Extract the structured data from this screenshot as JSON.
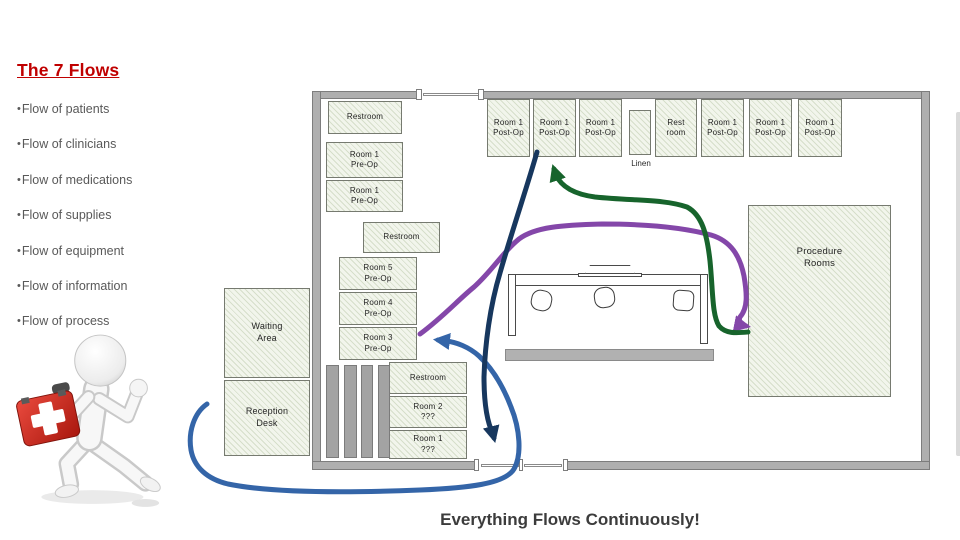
{
  "slide": {
    "title": "The 7 Flows",
    "bullet_char": "•",
    "bullets": [
      "Flow of patients",
      "Flow of clinicians",
      "Flow of medications",
      "Flow of supplies",
      "Flow of equipment",
      "Flow of information",
      "Flow of process"
    ],
    "caption": "Everything Flows Continuously!"
  },
  "colors": {
    "title_red": "#C00000",
    "bullet_text": "#595959",
    "caption_text": "#3c3c3c",
    "wall_gray": "#afafaf",
    "room_fill": "#f2f5ec",
    "flow_blue": "#3465A8",
    "flow_purple": "#8447A9",
    "flow_green": "#17642C",
    "flow_navy": "#17375E",
    "kit_red": "#C62B1F"
  },
  "floor_plan": {
    "linen_label": "Linen",
    "rooms": [
      {
        "id": "restroom-top-left",
        "label": "Restroom",
        "x": 328,
        "y": 101,
        "w": 74,
        "h": 33
      },
      {
        "id": "room1-preop-a",
        "label": "Room 1\nPre-Op",
        "x": 326,
        "y": 142,
        "w": 77,
        "h": 36
      },
      {
        "id": "room1-preop-b",
        "label": "Room 1\nPre-Op",
        "x": 326,
        "y": 180,
        "w": 77,
        "h": 32
      },
      {
        "id": "restroom-mid",
        "label": "Restroom",
        "x": 363,
        "y": 222,
        "w": 77,
        "h": 31
      },
      {
        "id": "room5-preop",
        "label": "Room 5\nPre-Op",
        "x": 339,
        "y": 257,
        "w": 78,
        "h": 33
      },
      {
        "id": "room4-preop",
        "label": "Room 4\nPre-Op",
        "x": 339,
        "y": 292,
        "w": 78,
        "h": 33
      },
      {
        "id": "room3-preop",
        "label": "Room 3\nPre-Op",
        "x": 339,
        "y": 327,
        "w": 78,
        "h": 33
      },
      {
        "id": "restroom-bottom",
        "label": "Restroom",
        "x": 389,
        "y": 362,
        "w": 78,
        "h": 32
      },
      {
        "id": "room2-unknown",
        "label": "Room 2\n???",
        "x": 389,
        "y": 396,
        "w": 78,
        "h": 32
      },
      {
        "id": "room1-unknown",
        "label": "Room 1\n???",
        "x": 389,
        "y": 430,
        "w": 78,
        "h": 29
      },
      {
        "id": "room1-postop-1",
        "label": "Room 1\nPost-Op",
        "x": 487,
        "y": 99,
        "w": 43,
        "h": 58
      },
      {
        "id": "room1-postop-2",
        "label": "Room 1\nPost-Op",
        "x": 533,
        "y": 99,
        "w": 43,
        "h": 58
      },
      {
        "id": "room1-postop-3",
        "label": "Room 1\nPost-Op",
        "x": 579,
        "y": 99,
        "w": 43,
        "h": 58
      },
      {
        "id": "linen-closet",
        "label": "",
        "x": 629,
        "y": 110,
        "w": 22,
        "h": 45
      },
      {
        "id": "restroom-top-right",
        "label": "Rest\nroom",
        "x": 655,
        "y": 99,
        "w": 42,
        "h": 58
      },
      {
        "id": "room1-postop-4",
        "label": "Room 1\nPost-Op",
        "x": 701,
        "y": 99,
        "w": 43,
        "h": 58
      },
      {
        "id": "room1-postop-5",
        "label": "Room 1\nPost-Op",
        "x": 749,
        "y": 99,
        "w": 43,
        "h": 58
      },
      {
        "id": "room1-postop-6",
        "label": "Room 1\nPost-Op",
        "x": 798,
        "y": 99,
        "w": 44,
        "h": 58
      },
      {
        "id": "procedure-rooms",
        "label": "Procedure\nRooms",
        "x": 748,
        "y": 205,
        "w": 143,
        "h": 192,
        "cls": "big"
      },
      {
        "id": "waiting-area",
        "label": "Waiting\nArea",
        "x": 224,
        "y": 288,
        "w": 86,
        "h": 90,
        "cls": "med"
      },
      {
        "id": "reception-desk",
        "label": "Reception\nDesk",
        "x": 224,
        "y": 380,
        "w": 86,
        "h": 76,
        "cls": "med"
      }
    ],
    "flows": [
      {
        "id": "patient-entry",
        "color": "#3465A8",
        "d": "M207,404 C194,413 188,432 191,450 C194,467 207,479 228,484 C272,493 345,493 420,490 C468,488 505,484 514,469 C522,455 520,429 511,407 C503,386 493,369 479,356 C469,347 456,342 446,341 L438,340"
      },
      {
        "id": "preop-to-procedure",
        "color": "#8447A9",
        "d": "M420,334 C443,317 458,300 474,287 C492,271 503,252 519,239 C535,227 562,225 602,224 C642,224 682,227 711,235 C731,241 740,256 744,276 C747,294 748,308 740,317 C738,322 741,325 746,326"
      },
      {
        "id": "procedure-to-postop",
        "color": "#17642C",
        "d": "M748,332 C736,333 726,334 719,326 C712,315 713,291 710,261 C707,234 702,215 687,207 C664,199 634,201 595,197 C573,194 561,186 556,175 L554,169"
      },
      {
        "id": "postop-to-exit",
        "color": "#17375E",
        "d": "M537,152 C528,184 511,234 500,273 C490,306 485,344 484,377 C484,404 487,422 493,434 L494,438"
      }
    ]
  }
}
